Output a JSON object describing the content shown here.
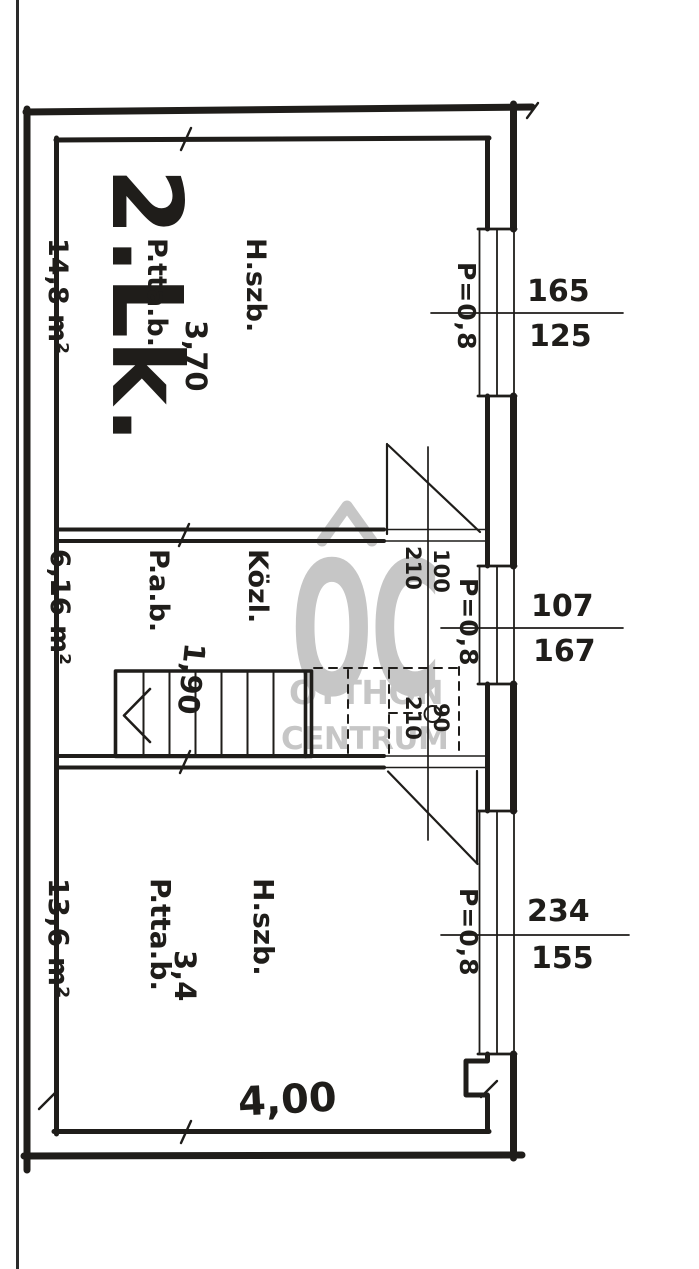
{
  "plan": {
    "unit_label": "2.Lk.",
    "rooms": [
      {
        "lines": [
          "H.szb.",
          "P.tta.b.",
          "14,8 m²"
        ],
        "width_label": "3,70"
      },
      {
        "lines": [
          "Közl.",
          "P.a.b.",
          "6,16 m²"
        ],
        "width_label": "1,90"
      },
      {
        "lines": [
          "H.szb.",
          "P.tta.b.",
          "13,6 m²"
        ],
        "width_label": "3,4"
      }
    ],
    "overall_width_label": "4,00",
    "windows": [
      {
        "parapet": "P=0,8",
        "top": "165",
        "bottom": "125"
      },
      {
        "parapet": "P=0,8",
        "top": "107",
        "bottom": "167"
      },
      {
        "parapet": "P=0,8",
        "top": "234",
        "bottom": "155"
      }
    ],
    "doors": [
      {
        "width": "100",
        "height": "210"
      },
      {
        "width": "90",
        "height": "210"
      }
    ]
  },
  "watermark": {
    "monogram": "OC",
    "line1": "OTTHON",
    "line2": "CENTRUM"
  },
  "colors": {
    "ink": "#1f1d1a",
    "paper": "#ffffff",
    "watermark": "#c6c6c6"
  }
}
